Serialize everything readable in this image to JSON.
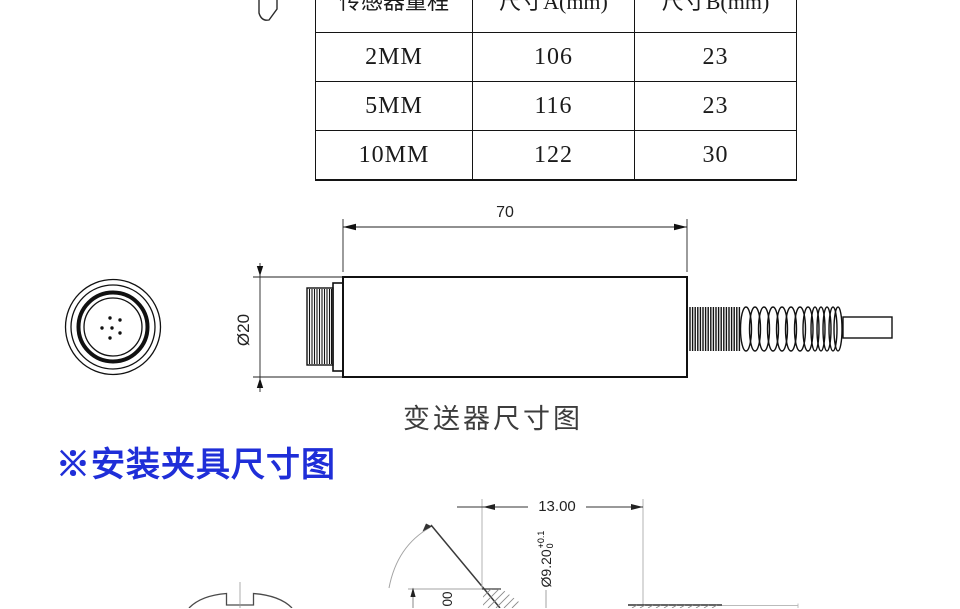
{
  "colors": {
    "accent_blue": "#1f2ed8",
    "caption_gray": "#3d3d3d"
  },
  "table": {
    "headers": [
      {
        "label": "传感器量程"
      },
      {
        "label": "尺寸A(mm)"
      },
      {
        "label": "尺寸B(mm)"
      }
    ],
    "rows": [
      {
        "range": "2MM",
        "dim_a": "106",
        "dim_b": "23"
      },
      {
        "range": "5MM",
        "dim_a": "116",
        "dim_b": "23"
      },
      {
        "range": "10MM",
        "dim_a": "122",
        "dim_b": "30"
      }
    ]
  },
  "transmitter": {
    "length_dim": "70",
    "diameter_dim": "Ø20",
    "caption": "变送器尺寸图"
  },
  "fixture": {
    "heading": "※安装夹具尺寸图",
    "width_dim": "13.00",
    "bore_dim": "Ø9.20",
    "bore_tol_upper": "+0.1",
    "bore_tol_lower": "0",
    "partial_vertical_dim": "00"
  }
}
